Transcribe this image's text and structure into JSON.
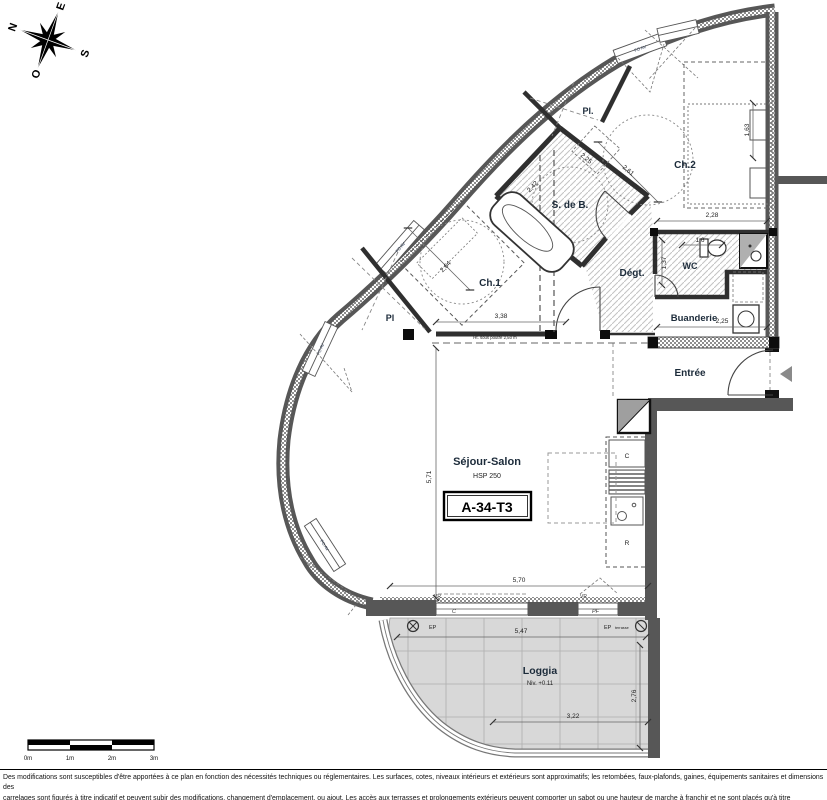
{
  "plan_code": "A-34-T3",
  "rooms": {
    "ch2": "Ch.2",
    "sdb": "S. de B.",
    "ch1": "Ch.1",
    "degt": "Dégt.",
    "wc": "WC",
    "buanderie": "Buanderie",
    "entree": "Entrée",
    "sejour": "Séjour-Salon",
    "sejour_note": "HSP 250",
    "loggia": "Loggia",
    "loggia_note": "Niv. +0.11",
    "placard_corridor": "Pl.",
    "placard_ch1": "Pl"
  },
  "dimensions": {
    "sejour_width": "5,70",
    "sejour_height": "5,71",
    "sejour_partial": "3,38",
    "loggia_width": "5,47",
    "loggia_partial": "3,22",
    "loggia_depth": "2,76",
    "ch2_width": "2,28",
    "ch2_diag": "2,61",
    "ch2_bed": "1,63",
    "sdb_diag": "2,25",
    "sdb_width": "2,42",
    "ch1_diag": "2,64",
    "wc_width": "1,6",
    "wc_depth": "1,37",
    "buanderie_width": "2,25",
    "beam_note": "Ht. sous poutre 2,50 m"
  },
  "annotations": {
    "kitchen_hob": "C",
    "kitchen_fridge": "R",
    "ep_left": "EP",
    "ep_right": "EP",
    "ep_right_sub": "terrasse",
    "vr_left": "VR",
    "vr_right": "VR",
    "window_sliding": "C",
    "window_french": "PF",
    "window_facade": "FO AV"
  },
  "compass": {
    "north": "N",
    "east": "E",
    "south": "S",
    "west": "O"
  },
  "scale_bar": {
    "t0": "0m",
    "t1": "1m",
    "t2": "2m",
    "t3": "3m"
  },
  "footer": {
    "line1": "Des modifications sont susceptibles d'être apportées à ce plan en fonction des nécessités techniques ou réglementaires. Les surfaces, cotes, niveaux intérieurs et extérieurs sont approximatifs; les retombées, faux-plafonds, gaines, équipements sanitaires et dimensions des",
    "line2": "carrelages sont figurés à titre indicatif et peuvent subir des modifications, changement d'emplacement, ou ajout. Les accès aux terrasses et prolongements extérieurs peuvent comporter un sabot ou une hauteur de marche à franchir et ne sont placés qu'à titre indicatif.Les",
    "line3": "appareils ménagers, meubles, végétaux ne sont pas fournis La surface de chaque pièce est calculée avec son éventuel placard. Une différence de 5% par rapport aux surfaces sera considéré comme admissible."
  },
  "colors": {
    "wall": "#575757",
    "accent_label": "#1c2b3a",
    "loggia_floor": "#d8d8d8"
  }
}
